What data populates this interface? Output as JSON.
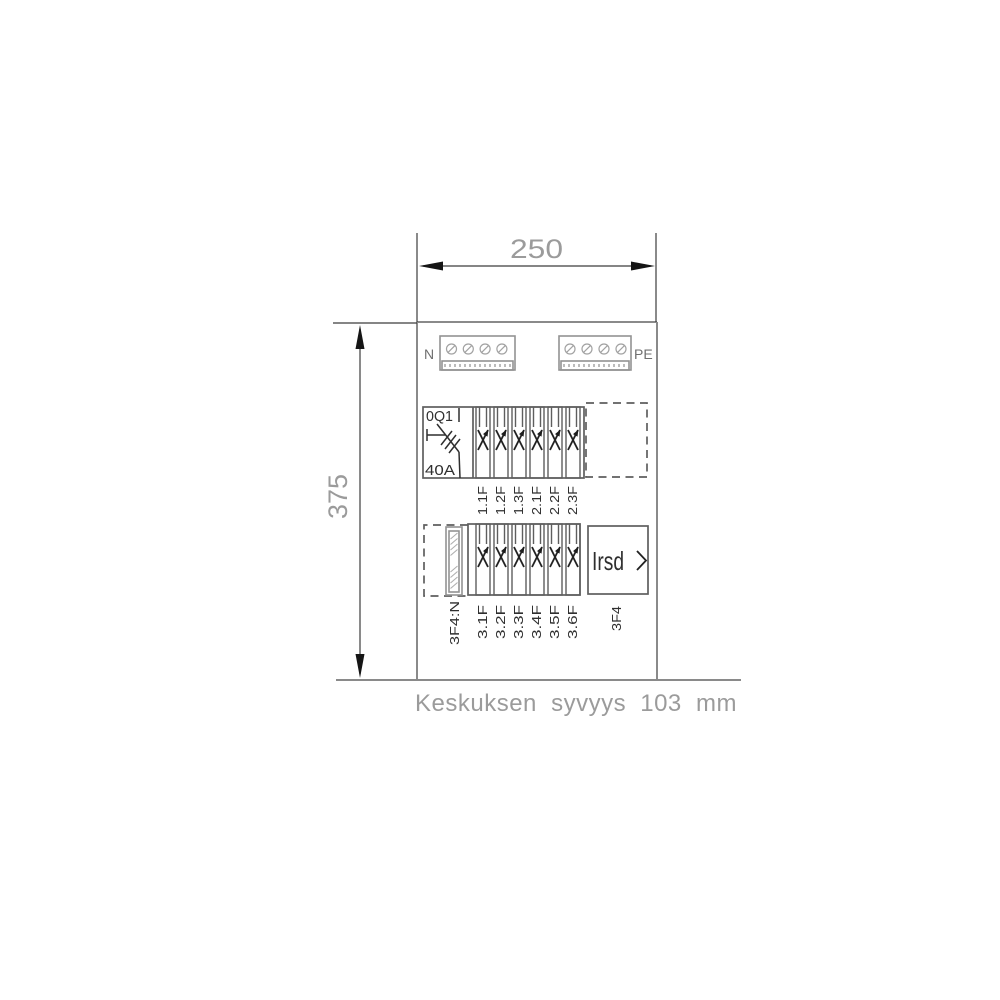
{
  "drawing": {
    "width_dimension": "250",
    "height_dimension": "375",
    "caption": "Keskuksen syvyys 103 mm"
  },
  "terminals": {
    "neutral_label": "N",
    "pe_label": "PE",
    "lower_strip_label": "3F4:N"
  },
  "main_switch": {
    "designation": "0Q1",
    "rating": "40A"
  },
  "upper_breakers": [
    "1.1F",
    "1.2F",
    "1.3F",
    "2.1F",
    "2.2F",
    "2.3F"
  ],
  "lower_breakers": [
    "3.1F",
    "3.2F",
    "3.3F",
    "3.4F",
    "3.5F",
    "3.6F"
  ],
  "lower_group": {
    "group_label": "3F4",
    "device_text": "Irsd",
    "chevron_icon": "chevron-right"
  },
  "colors": {
    "background": "#ffffff",
    "enclosure_line": "#8a8a8a",
    "component_line": "#5e5e5e",
    "symbol_line": "#2f2f2f",
    "dimension_text": "#9b9b9b",
    "arrow": "#151515"
  }
}
